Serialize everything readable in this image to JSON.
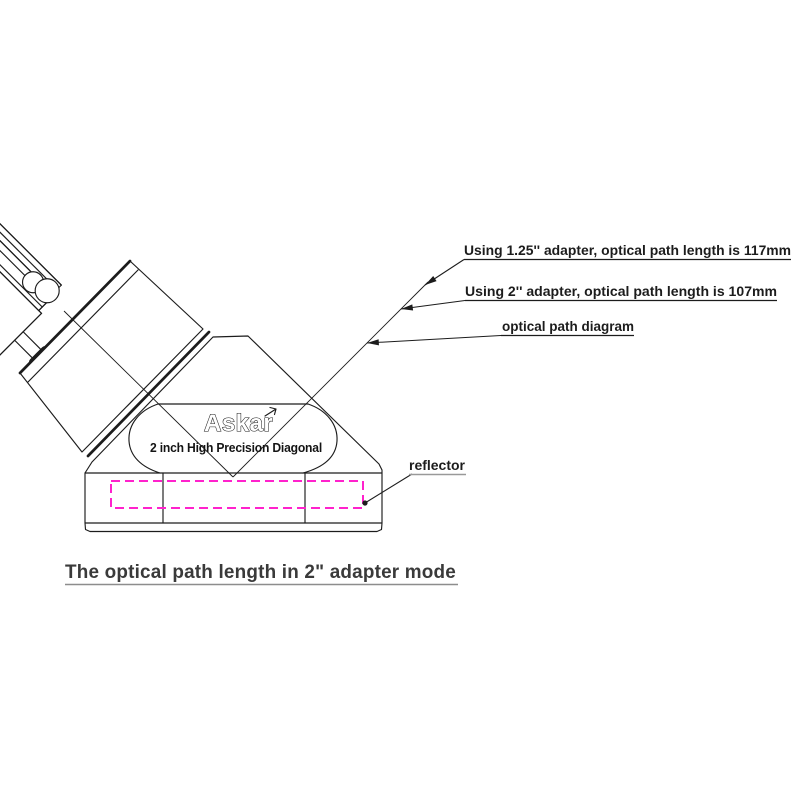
{
  "drawing": {
    "brand": "Askar",
    "product_label": "2 inch High Precision Diagonal",
    "annotations": {
      "adapter_125": "Using 1.25'' adapter, optical path length is 117mm",
      "adapter_2": "Using 2'' adapter, optical path length is 107mm",
      "optical_path": "optical path diagram",
      "reflector": "reflector"
    },
    "caption": "The optical path length in 2\" adapter mode",
    "colors": {
      "ink": "#1c1c1c",
      "reflector_dash": "#ff22cc",
      "caption_text": "#3a3a3a",
      "caption_underline": "#8d8d8d",
      "reflector_underline": "#999999"
    }
  }
}
